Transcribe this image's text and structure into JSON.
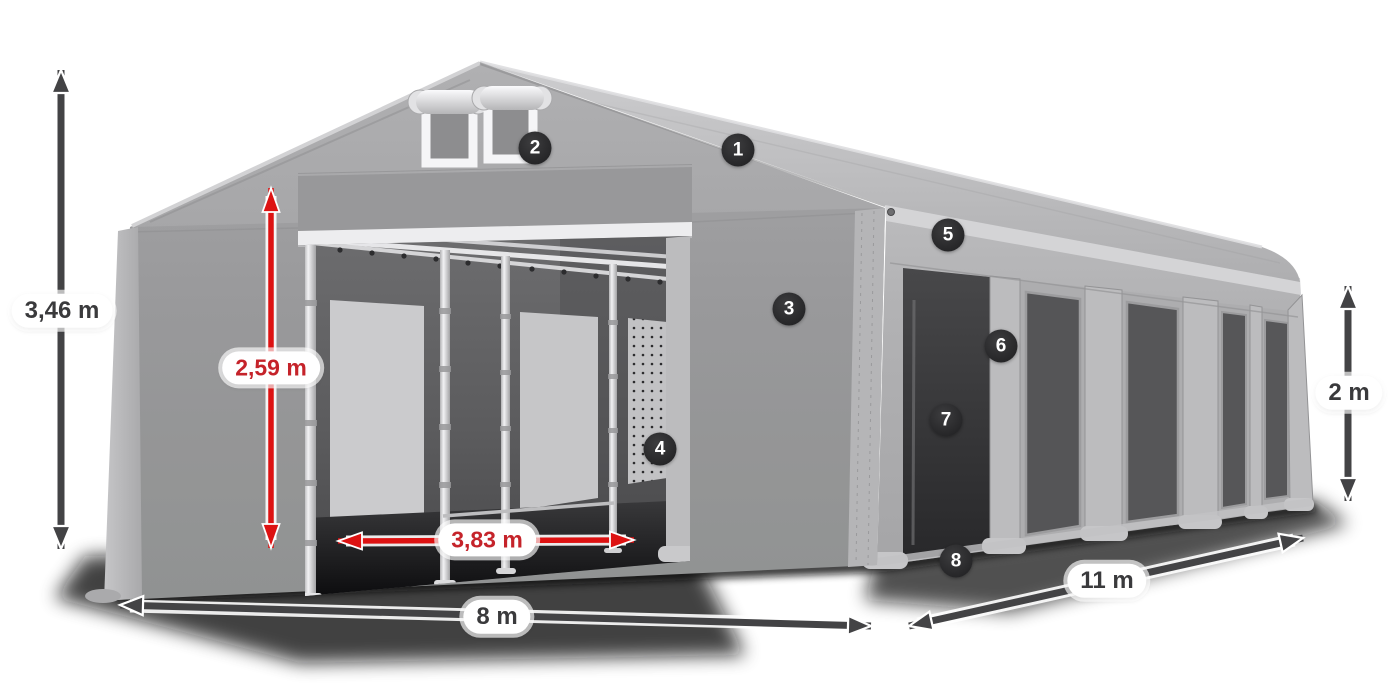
{
  "dimension_labels": {
    "total_height": "3,46 m",
    "inner_height": "2,59 m",
    "entrance_width": "3,83 m",
    "front_width": "8 m",
    "side_length": "11 m",
    "side_wall_height": "2 m"
  },
  "markers": [
    {
      "number": "1"
    },
    {
      "number": "2"
    },
    {
      "number": "3"
    },
    {
      "number": "4"
    },
    {
      "number": "5"
    },
    {
      "number": "6"
    },
    {
      "number": "7"
    },
    {
      "number": "8"
    }
  ],
  "colors": {
    "dimension_red_arrow": "#dd1212",
    "dimension_red_text": "#c5232a",
    "dimension_dark": "#434345",
    "label_background": "#ffffff",
    "label_text_dark": "#3a3a3c",
    "marker_background": "#2a2a2c",
    "marker_text": "#ffffff",
    "tent_gray": "#a8a8aa"
  }
}
